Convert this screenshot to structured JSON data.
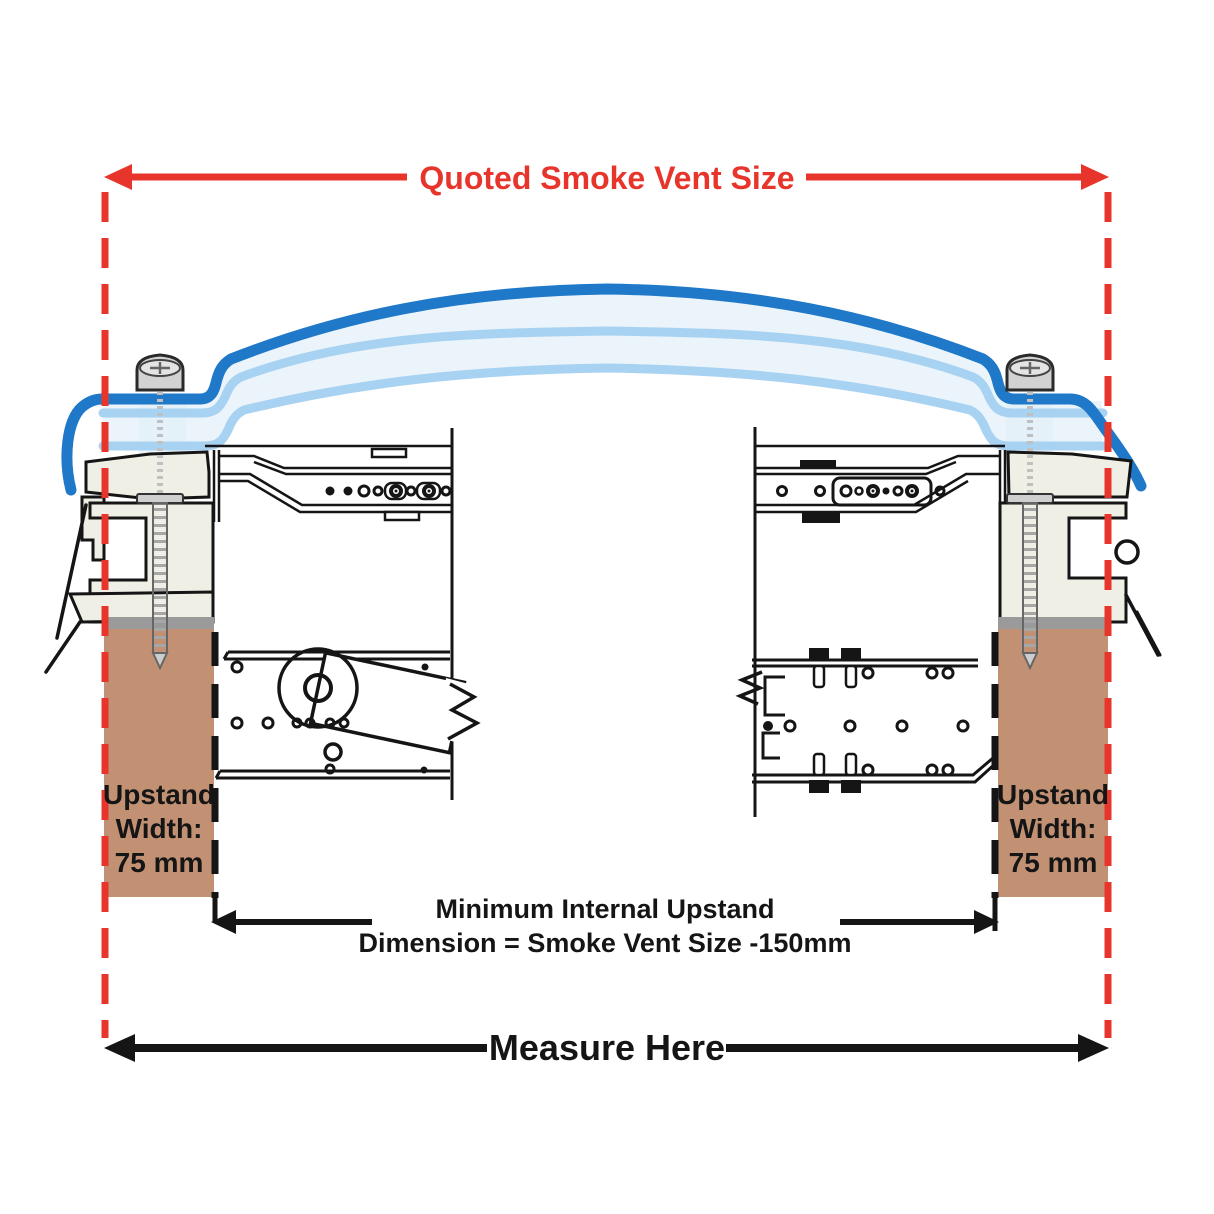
{
  "figure": {
    "title": "Smoke vent upstand cross-section measurement diagram"
  },
  "dimensions": {
    "quoted_size_label": "Quoted Smoke Vent Size",
    "internal_dimension_label_line1": "Minimum Internal Upstand",
    "internal_dimension_label_line2": "Dimension = Smoke Vent Size -150mm",
    "measure_here_label": "Measure Here",
    "upstand_left": {
      "line1": "Upstand",
      "line2": "Width:",
      "line3": "75 mm"
    },
    "upstand_right": {
      "line1": "Upstand",
      "line2": "Width:",
      "line3": "75 mm"
    }
  },
  "colors": {
    "dimension_red": "#e8352c",
    "dome_blue": "#1f78c8",
    "glazing_light_blue": "#a8d2f2",
    "glazing_fill": "#eaf4fa",
    "frame_cream": "#f0efe5",
    "timber_brown": "#c29173",
    "sill_grey": "#9a9a9a",
    "line_black": "#151515"
  }
}
